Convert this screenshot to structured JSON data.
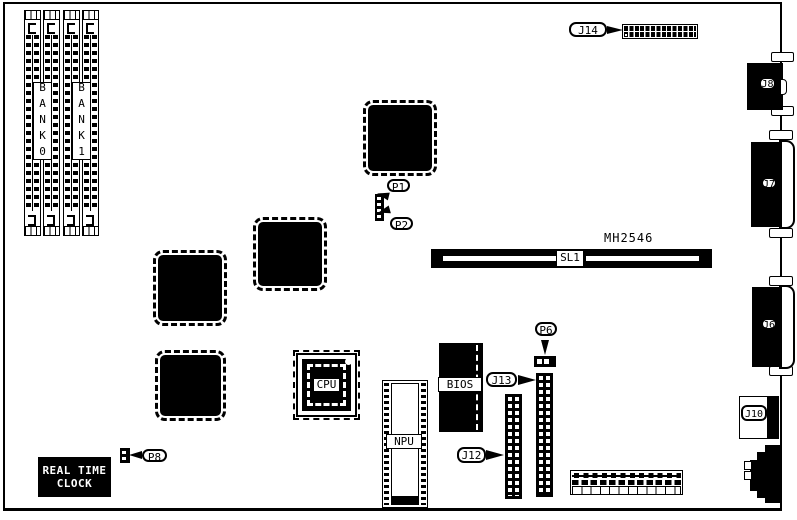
{
  "board": {
    "part_number": "MH2546"
  },
  "memory": {
    "bank0": "BANK0",
    "bank1": "BANK1"
  },
  "slot": {
    "label": "SL1"
  },
  "chips": {
    "cpu": "CPU",
    "npu": "NPU",
    "bios": "BIOS",
    "rtc_line1": "REAL TIME",
    "rtc_line2": "CLOCK"
  },
  "connectors": {
    "j14": "J14",
    "j13": "J13",
    "j12": "J12",
    "j10": "J10",
    "j8": "J8",
    "j7": "J7",
    "j6": "J6",
    "p1": "P1",
    "p2": "P2",
    "p6": "P6",
    "p8": "P8"
  },
  "colors": {
    "ink": "#000000",
    "paper": "#ffffff"
  }
}
